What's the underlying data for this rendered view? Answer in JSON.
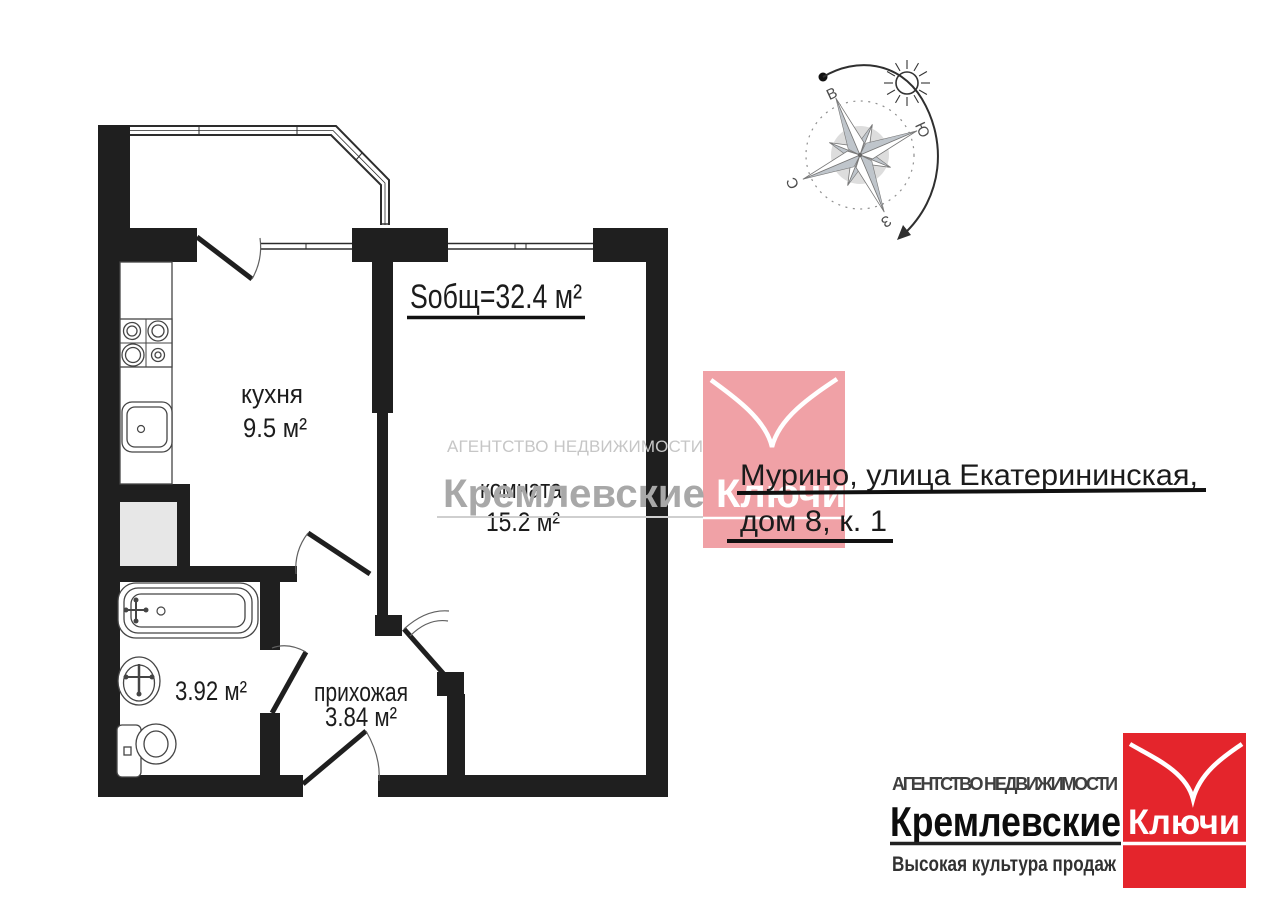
{
  "plan": {
    "total_area_label": "Sобщ=32.4 м²",
    "kitchen": {
      "name": "кухня",
      "area": "9.5 м²"
    },
    "living_room": {
      "name": "комната",
      "area": "15.2 м²"
    },
    "hallway": {
      "name": "прихожая",
      "area": "3.84 м²"
    },
    "bathroom": {
      "area": "3.92 м²"
    }
  },
  "compass": {
    "labels": {
      "east": "В",
      "south": "Ю",
      "north": "С",
      "west": "З"
    }
  },
  "address": {
    "line1": "Мурино, улица Екатерининская,",
    "line2": "дом 8, к. 1"
  },
  "watermark": {
    "agency": "АГЕНТСТВО НЕДВИЖИМОСТИ",
    "brand_gray": "Кремлевские",
    "brand_accent": "Ключи"
  },
  "logo": {
    "agency": "АГЕНТСТВО НЕДВИЖИМОСТИ",
    "brand_black": "Кремлевские",
    "brand_white": "Ключи",
    "tagline": "Высокая культура продаж"
  },
  "icons": {
    "compass_rose": "compass-rose-icon",
    "sun": "sun-icon",
    "rotation_arrow": "rotation-arrow-icon",
    "stove": "stove-icon",
    "kitchen_sink": "kitchen-sink-icon",
    "bathtub": "bathtub-icon",
    "washbasin": "washbasin-icon",
    "toilet": "toilet-icon",
    "brand_v": "v-mark-icon"
  },
  "colors": {
    "wall": "#1f1f1f",
    "ink": "#1c1c1c",
    "logo_red": "#e4252c",
    "watermark_pink": "#f0a1a6",
    "watermark_gray": "#a8a8a8",
    "watermark_light": "#c6c6c6"
  }
}
